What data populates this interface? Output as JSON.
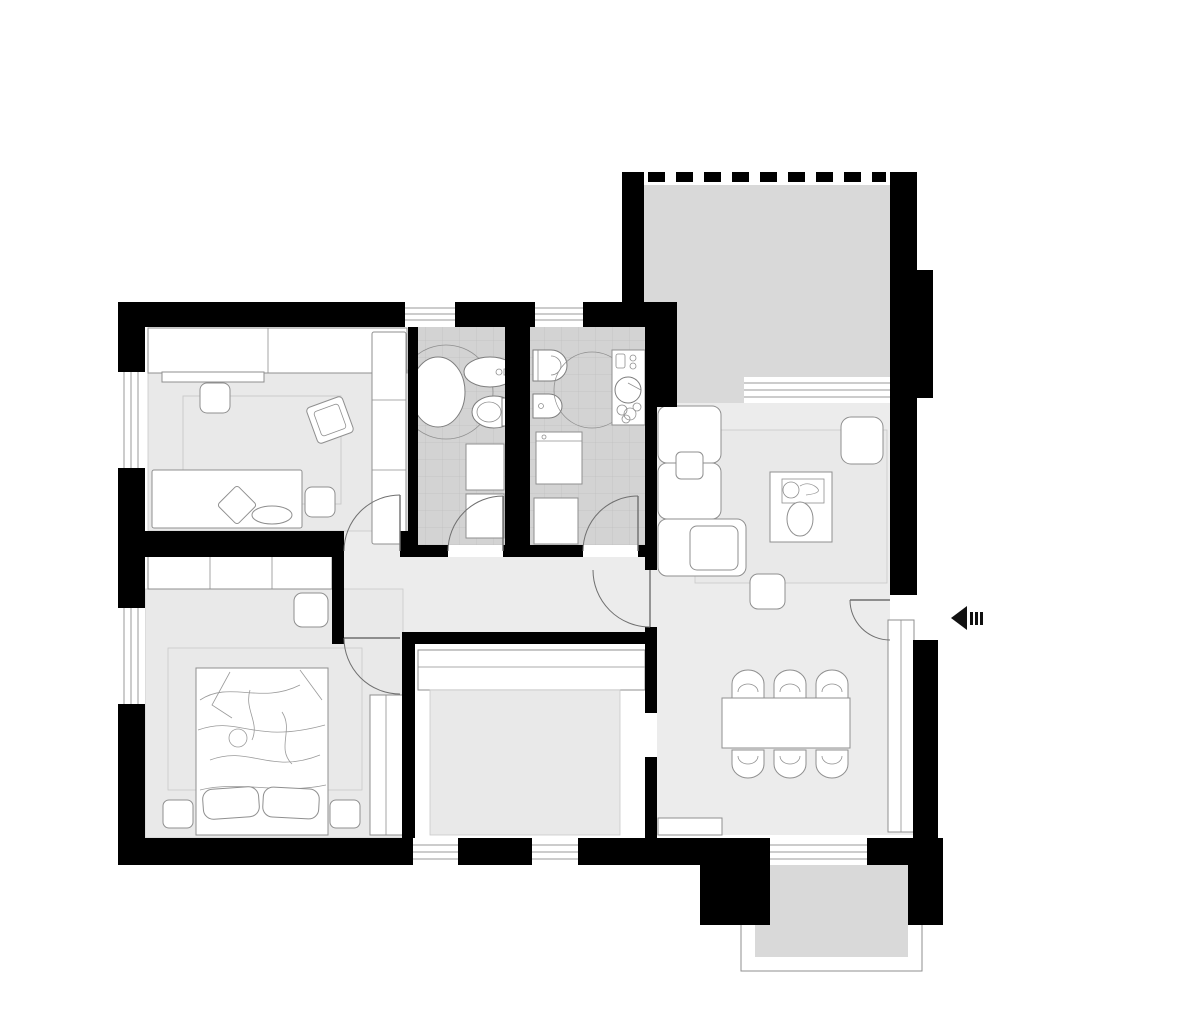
{
  "page": {
    "title": "Apartment floor plan"
  },
  "colors": {
    "wall": "#000000",
    "terrace": "#d9d9d9",
    "tile": "#d3d3d3",
    "tileLine": "#c0c0c0",
    "floorOpen": "#ececec",
    "rug": "#e9e9e9",
    "rugStroke": "#c9c9c9",
    "furnitureFill": "#ffffff",
    "furnitureStroke": "#8f8f8f",
    "fixtureStroke": "#7d7d7d",
    "windowLine": "#9a9a9a",
    "doorStroke": "#6f6f6f",
    "frameLine": "#8f8f8f",
    "duvetStroke": "#9a9a9a",
    "arrow": "#111111"
  },
  "entrance": {
    "symbol": "entrance-arrow",
    "direction": "left"
  },
  "floorplan": {
    "rooms": [
      {
        "id": "kids-bedroom",
        "furniture": [
          "desk",
          "shelf",
          "tall-wardrobe",
          "single-bed",
          "pillow",
          "cushion",
          "pouf",
          "pouf",
          "tilted-chair",
          "rug"
        ]
      },
      {
        "id": "bathroom-1",
        "furniture": [
          "bathtub",
          "bidet",
          "toilet",
          "storage-cabinet",
          "storage-cabinet"
        ]
      },
      {
        "id": "bathroom-2",
        "furniture": [
          "toilet",
          "bidet",
          "shower-circle",
          "vanity-sink",
          "plant",
          "washing-machine",
          "cabinet"
        ]
      },
      {
        "id": "master-bedroom",
        "furniture": [
          "wardrobe-top",
          "wardrobe-right",
          "double-bed",
          "pillow",
          "pillow",
          "nightstand",
          "nightstand",
          "pouf",
          "rug"
        ]
      },
      {
        "id": "kitchen",
        "furniture": [
          "counter",
          "rug"
        ]
      },
      {
        "id": "living-room",
        "furniture": [
          "corner-sofa",
          "rug",
          "coffee-table",
          "decor-tray",
          "vase",
          "armchair",
          "pouf"
        ]
      },
      {
        "id": "dining-area",
        "furniture": [
          "dining-table",
          "chair",
          "chair",
          "chair",
          "chair",
          "chair",
          "chair",
          "tall-cabinet",
          "sideboard"
        ]
      },
      {
        "id": "hallway",
        "furniture": []
      },
      {
        "id": "terrace-top",
        "furniture": []
      },
      {
        "id": "terrace-bottom",
        "furniture": []
      }
    ],
    "window_count": 8,
    "door_leaf_count": 6,
    "wall_opening_count": 2,
    "dining_chair_count": 6
  }
}
